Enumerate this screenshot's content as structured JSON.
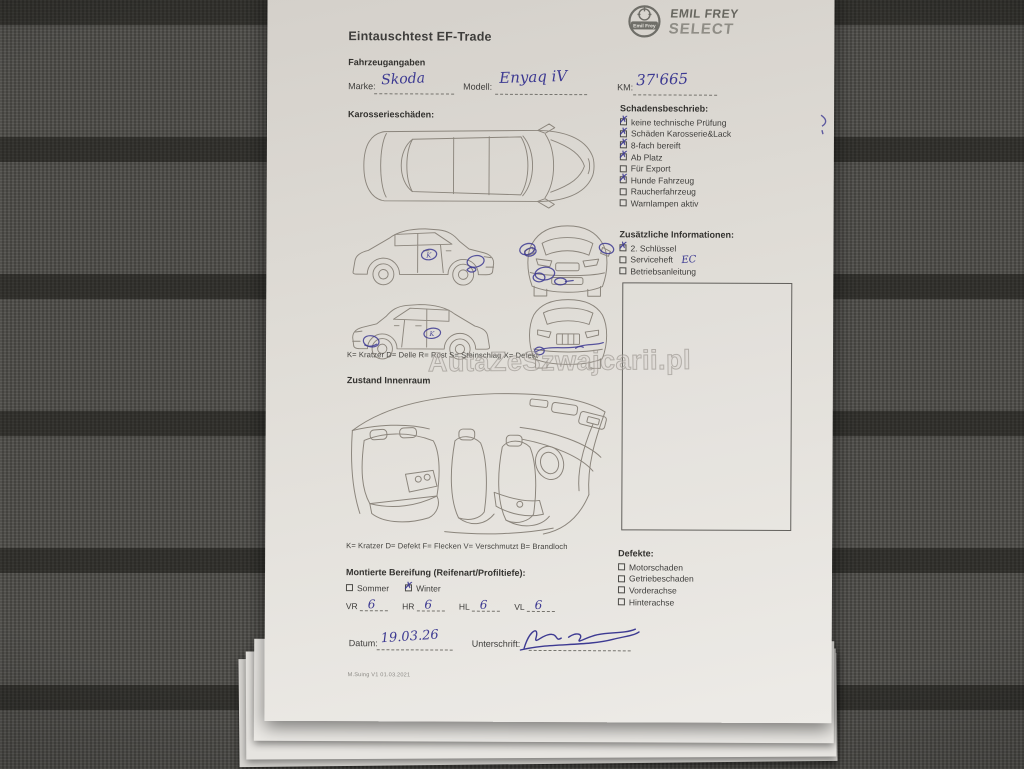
{
  "colors": {
    "ink": "#3d3a92",
    "paper": "#e3e0da",
    "carpet": "#4c4b47",
    "print": "#3e3d3b",
    "diagram": "#8b857c"
  },
  "watermark": {
    "text": "AutaZeSzwajcarii.pl"
  },
  "header": {
    "title": "Eintauschtest EF-Trade",
    "brand_top": "EMIL FREY",
    "brand_bottom": "SELECT",
    "emblem_text": "Emil Frey"
  },
  "vehicle": {
    "section": "Fahrzeugangaben",
    "marke_label": "Marke:",
    "marke_value": "Skoda",
    "modell_label": "Modell:",
    "modell_value": "Enyaq iV",
    "km_label": "KM:",
    "km_value": "37'665"
  },
  "body_section": {
    "heading": "Karosserieschäden:",
    "legend": "K= Kratzer D= Delle R= Rost S= Steinschlag X= Defekt",
    "mark_letter": "K"
  },
  "damage": {
    "heading": "Schadensbeschrieb:",
    "items": [
      {
        "label": "keine technische Prüfung",
        "checked": true
      },
      {
        "label": "Schäden Karosserie&Lack",
        "checked": true
      },
      {
        "label": "8-fach bereift",
        "checked": true
      },
      {
        "label": "Ab Platz",
        "checked": true
      },
      {
        "label": "Für Export",
        "checked": false
      },
      {
        "label": "Hunde Fahrzeug",
        "checked": true
      },
      {
        "label": "Raucherfahrzeug",
        "checked": false
      },
      {
        "label": "Warnlampen aktiv",
        "checked": false
      }
    ]
  },
  "additional": {
    "heading": "Zusätzliche Informationen:",
    "items": [
      {
        "label": "2. Schlüssel",
        "checked": true,
        "note": ""
      },
      {
        "label": "Serviceheft",
        "checked": false,
        "note": "EC"
      },
      {
        "label": "Betriebsanleitung",
        "checked": false,
        "note": ""
      }
    ]
  },
  "interior_section": {
    "heading": "Zustand Innenraum",
    "legend": "K= Kratzer D= Defekt F= Flecken V= Verschmutzt B= Brandloch"
  },
  "tires": {
    "heading": "Montierte Bereifung (Reifenart/Profiltiefe):",
    "options": [
      {
        "label": "Sommer",
        "checked": false
      },
      {
        "label": "Winter",
        "checked": true
      }
    ],
    "positions": [
      {
        "label": "VR",
        "value": "6"
      },
      {
        "label": "HR",
        "value": "6"
      },
      {
        "label": "HL",
        "value": "6"
      },
      {
        "label": "VL",
        "value": "6"
      }
    ]
  },
  "defects": {
    "heading": "Defekte:",
    "items": [
      {
        "label": "Motorschaden",
        "checked": false
      },
      {
        "label": "Getriebeschaden",
        "checked": false
      },
      {
        "label": "Vorderachse",
        "checked": false
      },
      {
        "label": "Hinterachse",
        "checked": false
      }
    ]
  },
  "signature_row": {
    "datum_label": "Datum:",
    "datum_value": "19.03.26",
    "unterschrift_label": "Unterschrift:"
  },
  "footer": {
    "version": "M.Suing V1 01.03.2021"
  }
}
